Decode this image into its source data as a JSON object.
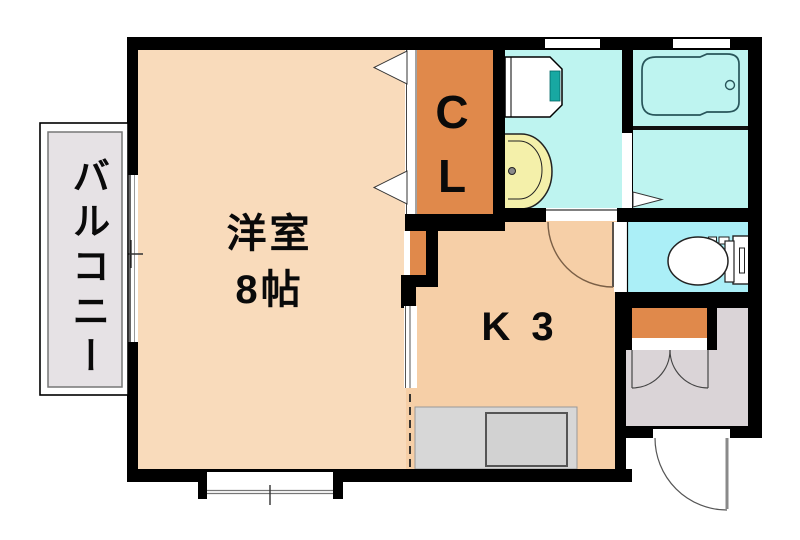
{
  "labels": {
    "balcony": "バルコニー",
    "western_room": "洋室\n8帖",
    "closet": "C\nL",
    "kitchen": "K 3"
  },
  "colors": {
    "wall": "#000000",
    "western_room": "#F9DBBB",
    "kitchen": "#F6CFA7",
    "closet_orange": "#E0894B",
    "bath_cyan": "#BEF4F0",
    "toilet_cyan": "#ABEFF7",
    "sink_yellow": "#F4F0AA",
    "teal_accent": "#18A8A2",
    "balcony_floor": "#E6E2E5",
    "entry_floor": "#DAD4D7",
    "counter_gray": "#D7D7D7",
    "counter_inner_gray": "#D2D2D2",
    "fixture_white": "#FFFFFF"
  }
}
